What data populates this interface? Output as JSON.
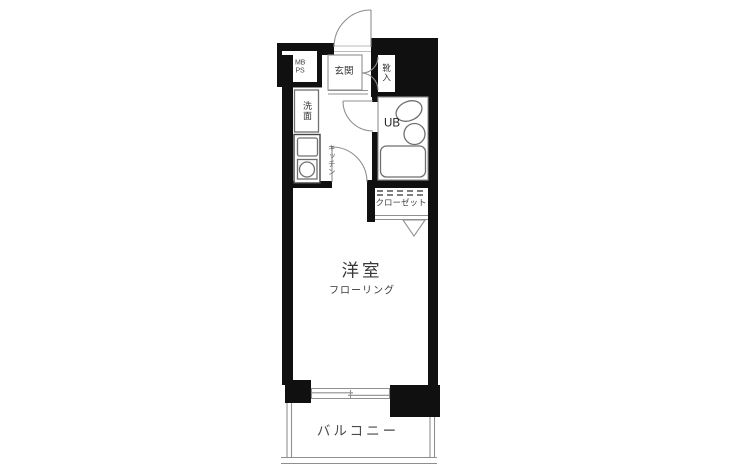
{
  "floor_plan": {
    "labels": {
      "meter_box": {
        "line1": "MB",
        "line2": "PS"
      },
      "entrance": "玄関",
      "shoe_cabinet": "靴入",
      "washroom": "洗面",
      "kitchen": "キッチン",
      "unit_bath": "UB",
      "closet": "クローゼット",
      "main_room": "洋室",
      "main_room_floor": "フローリング",
      "balcony": "バルコニー"
    },
    "colors": {
      "wall": "#101010",
      "line": "#8f8f8f",
      "fixture": "#6f6f6f",
      "text": "#333333",
      "background": "#ffffff"
    }
  }
}
